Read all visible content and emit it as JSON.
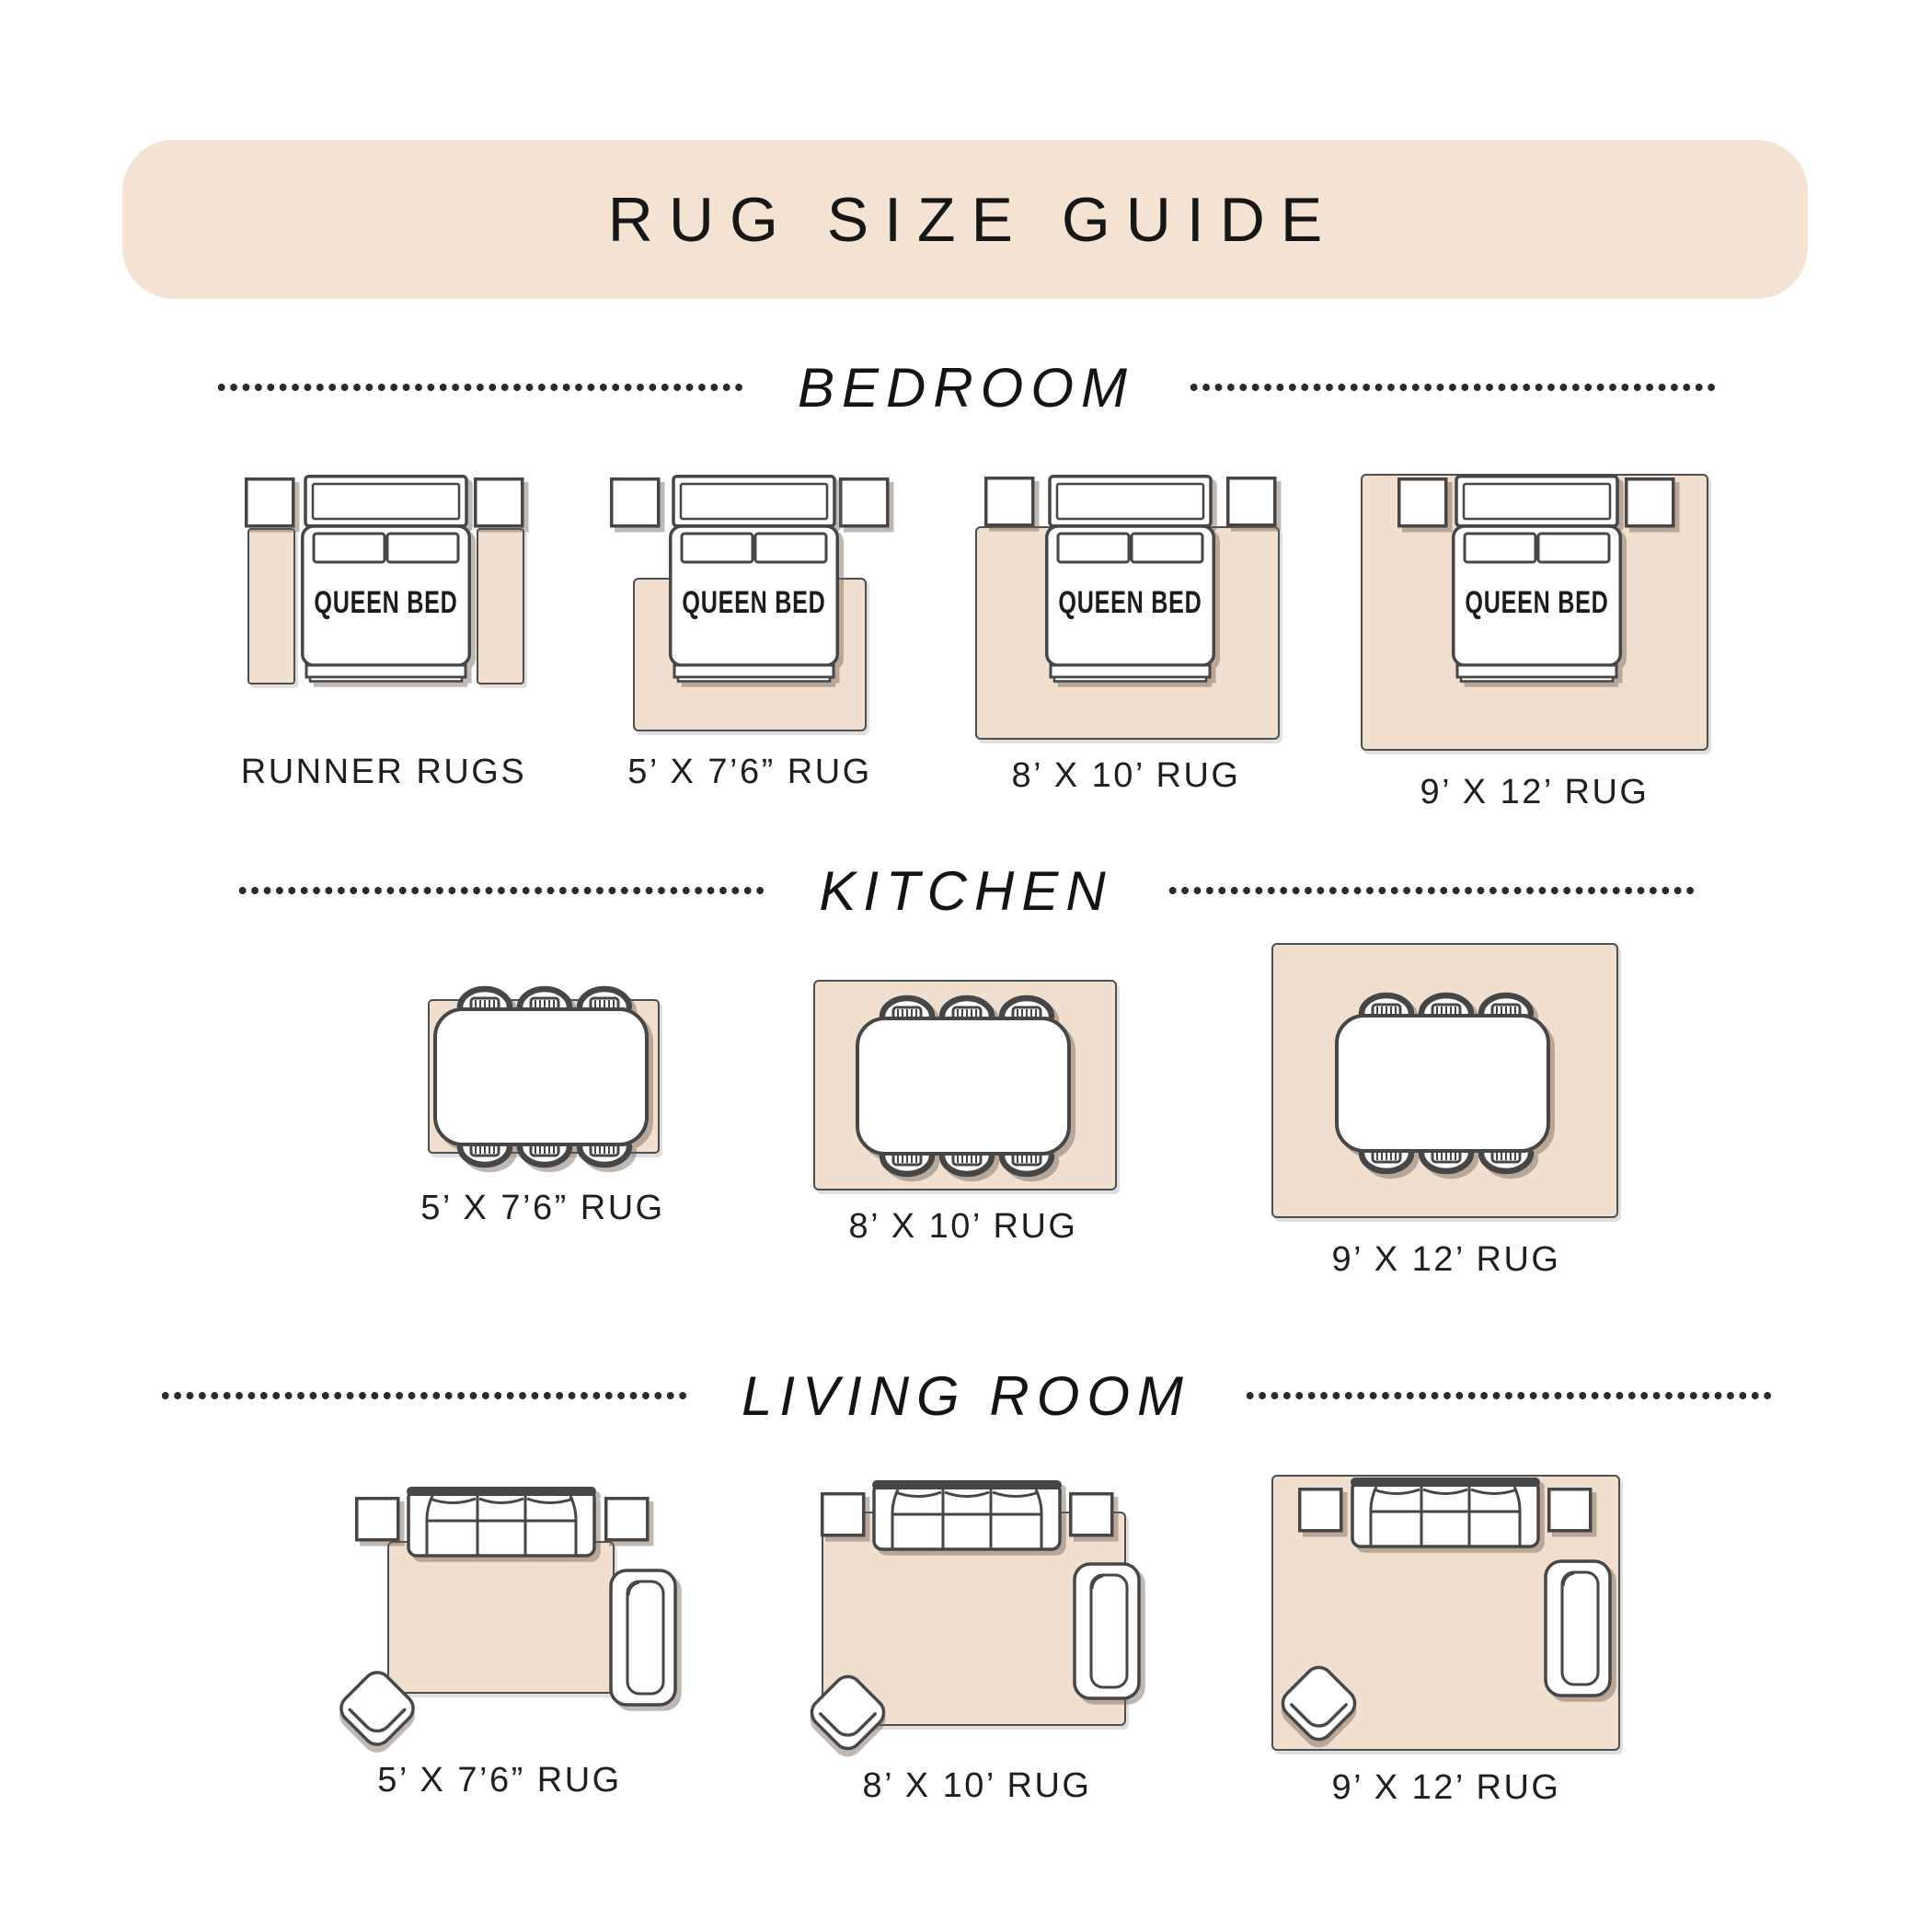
{
  "title": "RUG SIZE GUIDE",
  "bed_label": "QUEEN BED",
  "sections": [
    {
      "name": "BEDROOM",
      "items": [
        "RUNNER RUGS",
        "5’ X 7’6” RUG",
        "8’ X 10’ RUG",
        "9’ X 12’ RUG"
      ]
    },
    {
      "name": "KITCHEN",
      "items": [
        "5’ X 7’6” RUG",
        "8’ X 10’ RUG",
        "9’ X 12’ RUG"
      ]
    },
    {
      "name": "LIVING ROOM",
      "items": [
        "5’ X 7’6” RUG",
        "8’ X 10’ RUG",
        "9’ X 12’ RUG"
      ]
    }
  ],
  "colors": {
    "banner_bg": "#f4e3d3",
    "rug_fill": "#f0dfcf",
    "outline": "#464646",
    "text": "#1c1c1c",
    "divider_dot": "#2b2b2b"
  }
}
